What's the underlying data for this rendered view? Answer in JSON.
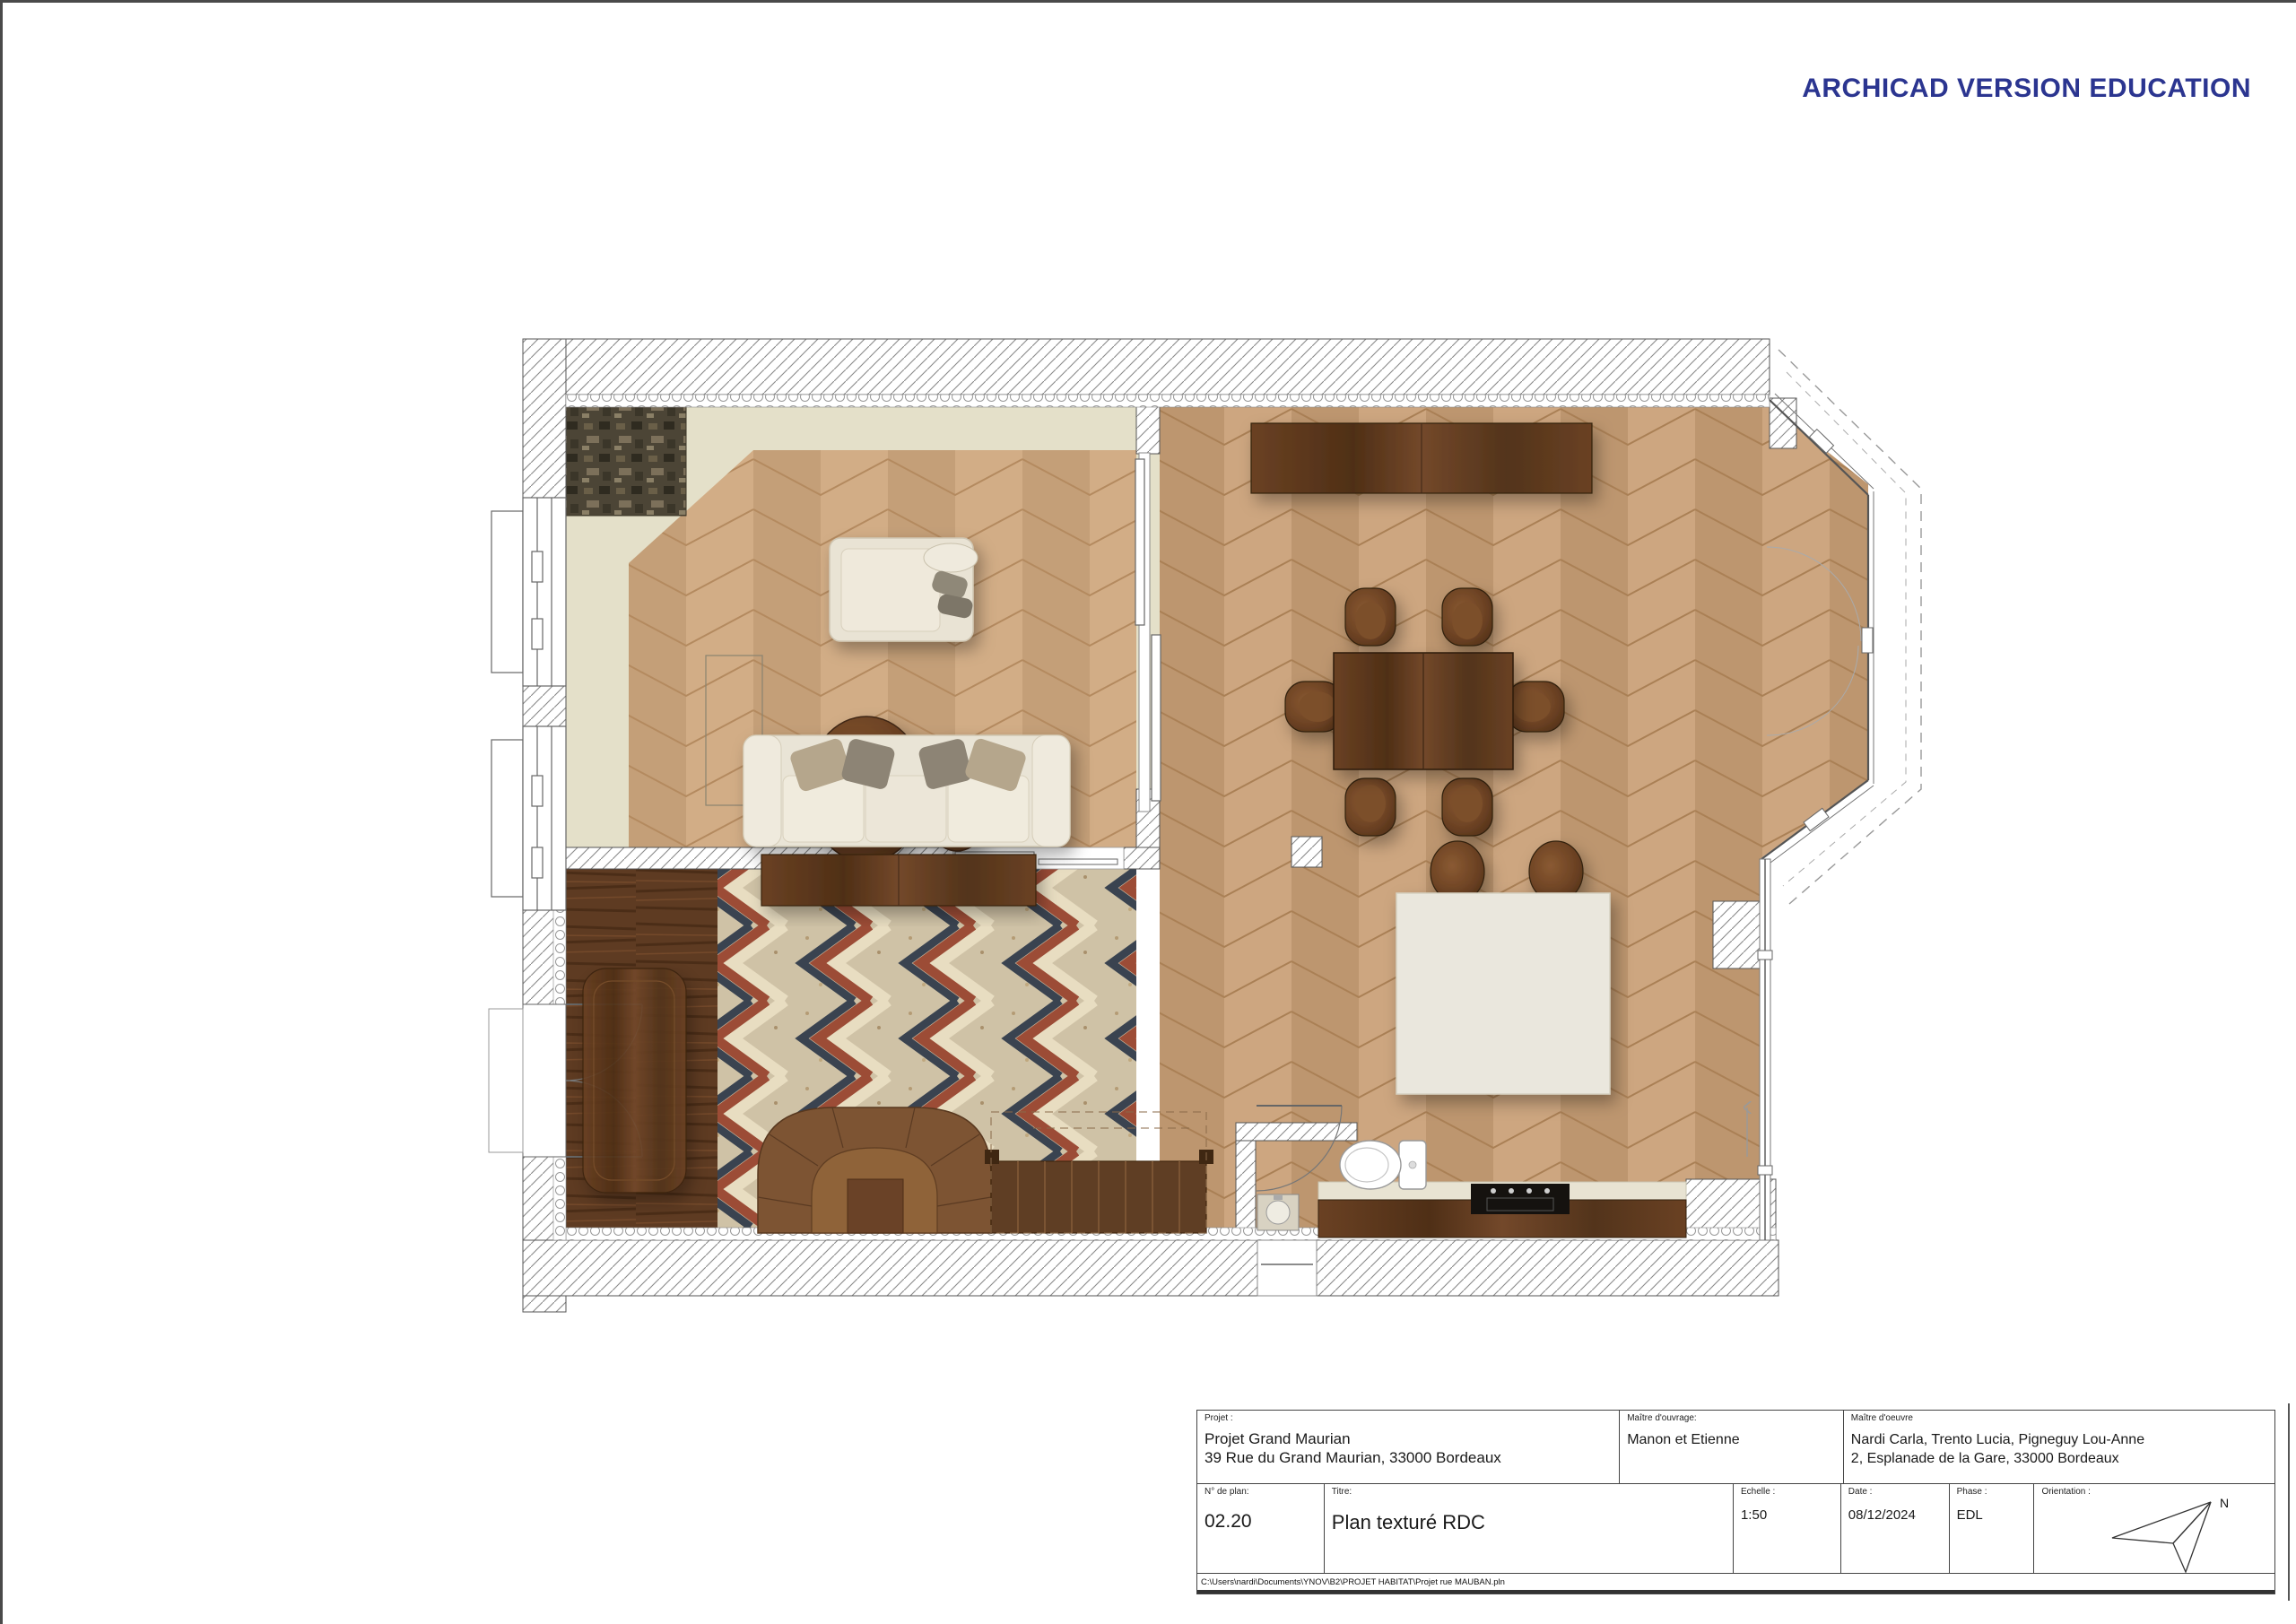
{
  "banner": {
    "text": "ARCHICAD VERSION EDUCATION",
    "color": "#2b3590"
  },
  "title_block": {
    "project": {
      "label": "Projet :",
      "line1": "Projet Grand Maurian",
      "line2": "39 Rue du Grand Maurian, 33000 Bordeaux"
    },
    "client": {
      "label": "Maître d'ouvrage:",
      "value": "Manon et Etienne"
    },
    "architect": {
      "label": "Maître d'oeuvre",
      "line1": "Nardi Carla, Trento Lucia, Pigneguy Lou-Anne",
      "line2": "2, Esplanade de la Gare, 33000 Bordeaux"
    },
    "plan_number": {
      "label": "N° de plan:",
      "value": "02.20"
    },
    "title": {
      "label": "Titre:",
      "value": "Plan texturé RDC"
    },
    "scale": {
      "label": "Echelle :",
      "value": "1:50"
    },
    "date": {
      "label": "Date :",
      "value": "08/12/2024"
    },
    "phase": {
      "label": "Phase :",
      "value": "EDL"
    },
    "orientation": {
      "label": "Orientation :",
      "north": "N"
    }
  },
  "footer": {
    "file_path": "C:\\Users\\nardi\\Documents\\YNOV\\B2\\PROJET HABITAT\\Projet rue MAUBAN.pln"
  },
  "plan": {
    "drawing_title": "Plan texturé RDC",
    "colors": {
      "accent_blue": "#2b3590",
      "parquet_light": "#cfa87e",
      "parquet_seam": "#b48a5f",
      "cream_band": "#e4e0c9",
      "walnut_dark": "#5d3a1f",
      "mosaic_red": "#9c4c36",
      "mosaic_navy": "#3a4350",
      "mosaic_cream": "#e8ddc1",
      "stair_wood": "#7d5433",
      "island_white": "#eae7dd"
    }
  }
}
